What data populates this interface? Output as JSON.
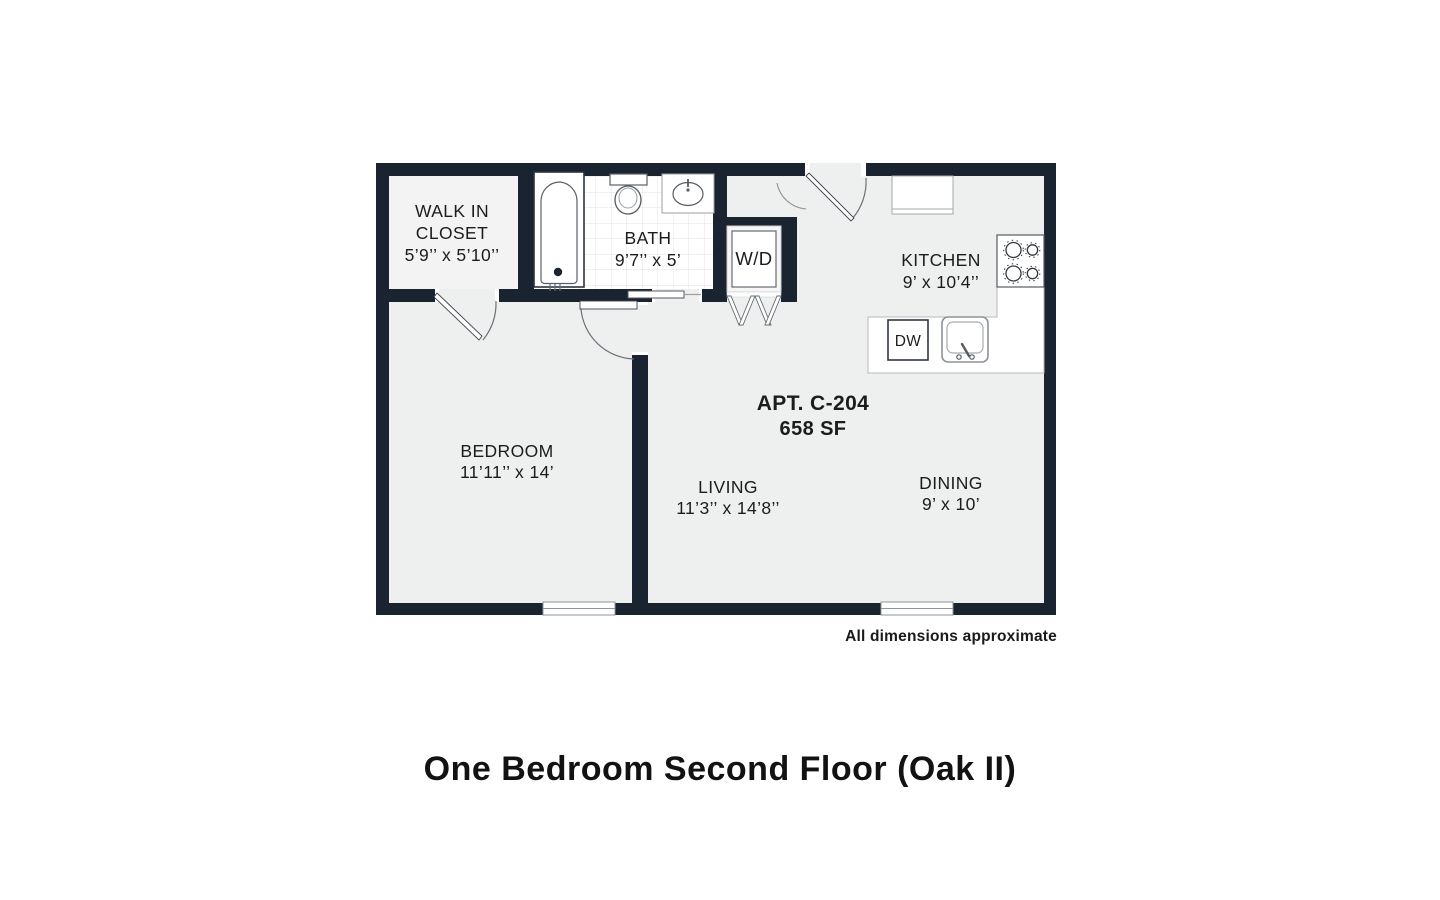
{
  "title": "One Bedroom Second Floor (Oak II)",
  "footnote": "All dimensions approximate",
  "apartment": {
    "number": "APT. C-204",
    "area": "658 SF"
  },
  "rooms": {
    "closet": {
      "line1": "WALK IN",
      "line2": "CLOSET",
      "dims": "5’9’’ x 5’10’’"
    },
    "bath": {
      "name": "BATH",
      "dims": "9’7’’ x 5’"
    },
    "kitchen": {
      "name": "KITCHEN",
      "dims": "9’ x 10’4’’"
    },
    "bedroom": {
      "name": "BEDROOM",
      "dims": "11’11’’ x 14’"
    },
    "living": {
      "name": "LIVING",
      "dims": "11’3’’ x 14’8’’"
    },
    "dining": {
      "name": "DINING",
      "dims": "9’ x 10’"
    }
  },
  "appliances": {
    "washer_dryer": "W/D",
    "dishwasher": "DW"
  },
  "colors": {
    "wall": "#1a2330",
    "floor": "#eeefef",
    "tile_line": "#e3e3e3",
    "text": "#1c1c1e"
  }
}
